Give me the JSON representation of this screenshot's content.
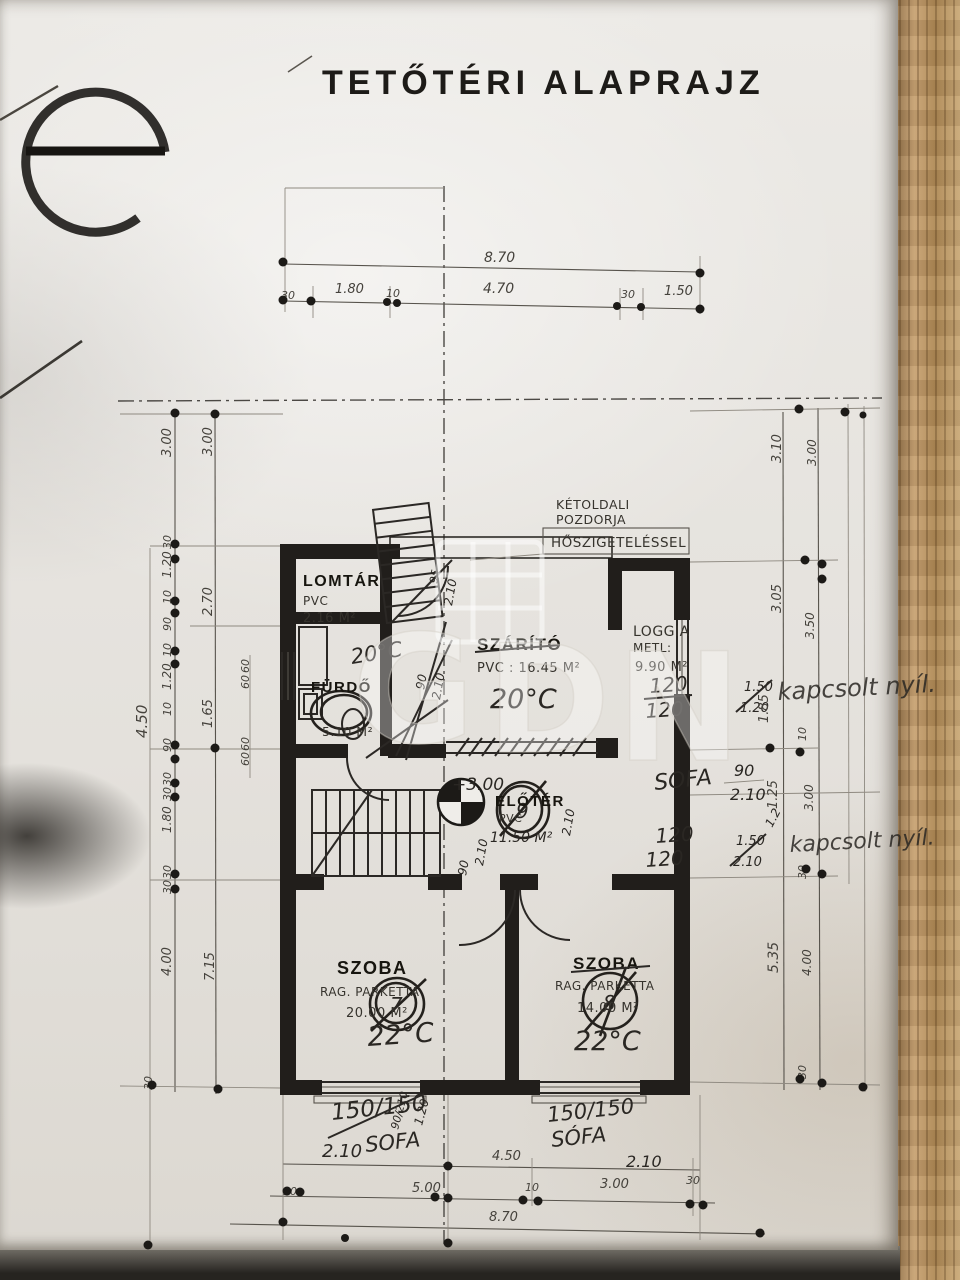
{
  "title": "TETŐTÉRI ALAPRAJZ",
  "stamp_letter": "e",
  "watermark": {
    "letters": [
      "G",
      "D",
      "N"
    ]
  },
  "insulation_note": {
    "l1": "KÉTOLDALI",
    "l2": "POZDORJA",
    "l3": "HŐSZIGETELÉSSEL"
  },
  "rooms": {
    "lomtar": {
      "name": "LOMTÁR",
      "floor": "PVC",
      "area": "2.16 M²"
    },
    "furdo": {
      "name": "FÜRDŐ",
      "area": "5.10 M²",
      "temp": "20°C"
    },
    "szarito": {
      "name": "SZÁRÍTÓ",
      "spec": "PVC : 16.45 M²",
      "temp": "20°C"
    },
    "loggia": {
      "name": "LOGGIA",
      "floor": "METL:",
      "area": "9.90 M²"
    },
    "eloter": {
      "name": "ELŐTÉR",
      "floor": "PVC",
      "area": "11.50 M²",
      "level": "+3.00",
      "number": "9"
    },
    "szoba_left": {
      "name": "SZOBA",
      "floor": "RAG. PARKETTA",
      "area": "20.00 M²",
      "temp": "22°C",
      "number": "7"
    },
    "szoba_right": {
      "name": "SZOBA",
      "floor": "RAG. PARKETTA",
      "area": "14.00 M²",
      "temp": "22°C",
      "number": "8"
    }
  },
  "handwritten": {
    "win1": {
      "w1": "120",
      "w2": "120",
      "s1": "1.50",
      "s2": "1.20",
      "note": "kapcsolt nyíl."
    },
    "sofa1": {
      "label": "SOFA",
      "top": "90",
      "bottom": "2.10"
    },
    "win2": {
      "w1": "120",
      "w2": "120",
      "s1": "1.50",
      "s2": "2.10",
      "extra": "1.2",
      "note": "kapcsolt nyíl."
    },
    "sofa_bl": {
      "size": "150/150",
      "v1": "90/210",
      "v2": "1.20",
      "w": "2.10",
      "label": "SOFA"
    },
    "sofa_br": {
      "size": "150/150",
      "label": "SÓFA",
      "w": "2.10"
    },
    "door_sizes": [
      "2.10",
      "95",
      "90",
      "2.10",
      "2.10",
      "90",
      "2.10"
    ]
  },
  "dims": {
    "top": {
      "total": "8.70",
      "segments": [
        "30",
        "1.80",
        "10",
        "4.70",
        "30",
        "1.50"
      ]
    },
    "bottom": {
      "inner": "4.50",
      "row": [
        "30",
        "5.00",
        "10",
        "3.00",
        "30"
      ],
      "total": "8.70"
    },
    "left": {
      "outer": [
        "3.00",
        "30",
        "1.20",
        "10",
        "90",
        "10",
        "1.20",
        "10",
        "90",
        "30",
        "30",
        "1.80",
        "30",
        "30",
        "4.00",
        "30"
      ],
      "inner": [
        "3.00",
        "2.70",
        "1.65",
        "7.15"
      ],
      "small": [
        "60",
        "60",
        "60",
        "60"
      ],
      "far": "4.50"
    },
    "right": {
      "outer": [
        "3.10",
        "3.05",
        "1.85",
        "1.25",
        "5.35"
      ],
      "inner": [
        "3.00",
        "3.50",
        "10",
        "3.00",
        "30",
        "4.00",
        "30"
      ]
    }
  }
}
